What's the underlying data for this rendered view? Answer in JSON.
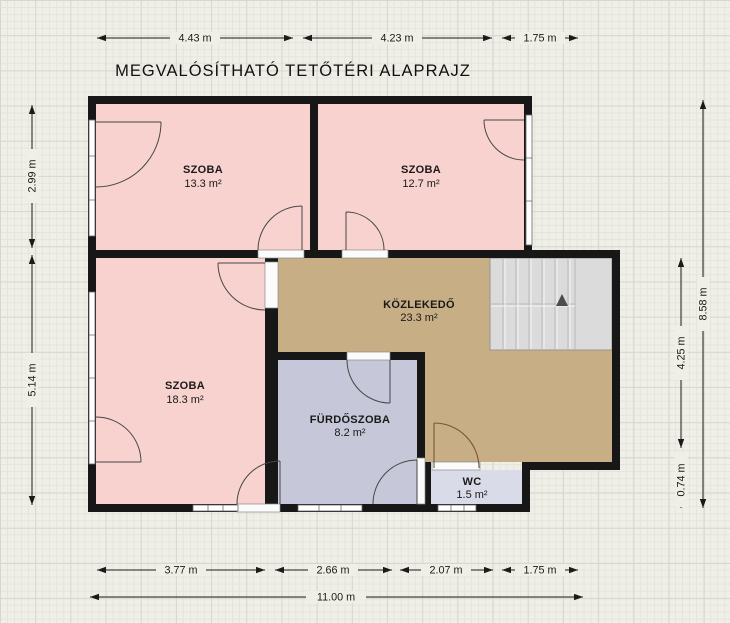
{
  "title": "MEGVALÓSÍTHATÓ TETŐTÉRI ALAPRAJZ",
  "rooms": [
    {
      "name": "SZOBA",
      "area": "13.3 m²"
    },
    {
      "name": "SZOBA",
      "area": "12.7 m²"
    },
    {
      "name": "SZOBA",
      "area": "18.3 m²"
    },
    {
      "name": "KÖZLEKEDŐ",
      "area": "23.3 m²"
    },
    {
      "name": "FÜRDŐSZOBA",
      "area": "8.2 m²"
    },
    {
      "name": "WC",
      "area": "1.5 m²"
    }
  ],
  "dimensions": {
    "top": [
      "4.43 m",
      "4.23 m",
      "1.75 m"
    ],
    "left": [
      "2.99 m",
      "5.14 m"
    ],
    "right_inner": [
      "4.25 m",
      "0.74 m"
    ],
    "right_outer": "8.58 m",
    "bottom": [
      "3.77 m",
      "2.66 m",
      "2.07 m",
      "1.75 m"
    ],
    "bottom_total": "11.00 m"
  },
  "colors": {
    "room_pink": "#f8d2ce",
    "corridor_tan": "#c8ae85",
    "bathroom_lavender": "#c6c7d8",
    "wc_lavender": "#dadbe8",
    "wall_black": "#171717",
    "stair_gray": "#dbdbdb"
  }
}
